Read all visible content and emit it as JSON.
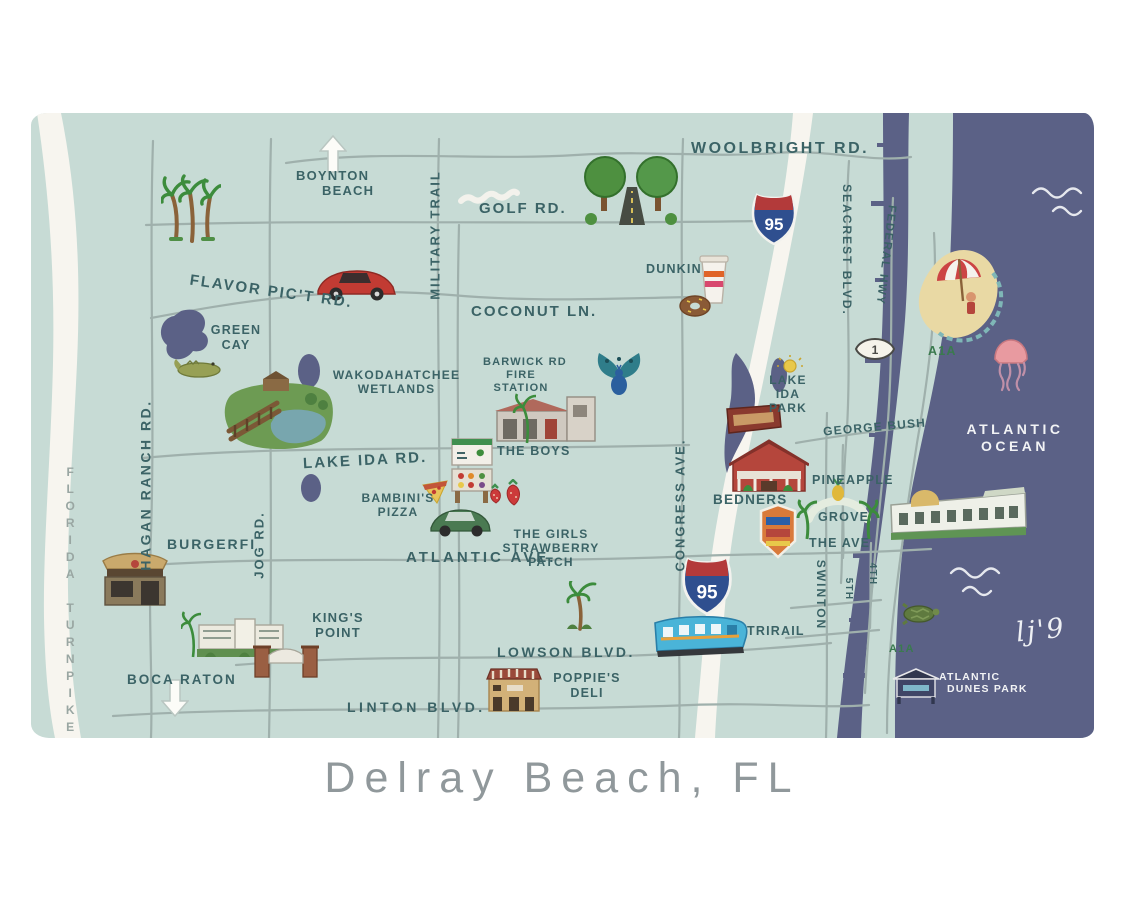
{
  "title": "Delray Beach, FL",
  "signature": "lj'9",
  "roads": {
    "woolbright": "WOOLBRIGHT RD.",
    "golf": "GOLF RD.",
    "flavor_pict": "FLAVOR PIC'T RD.",
    "coconut": "COCONUT LN.",
    "lake_ida": "LAKE IDA RD.",
    "atlantic": "ATLANTIC AVE.",
    "lowson": "LOWSON BLVD.",
    "linton": "LINTON BLVD.",
    "military": "MILITARY TRAIL",
    "hagan_ranch": "HAGAN RANCH RD.",
    "jog": "JOG RD.",
    "congress": "CONGRESS AVE.",
    "seacrest": "SEACREST BLVD.",
    "federal": "FEDERAL HWY",
    "swinton": "SWINTON",
    "fifth": "5TH",
    "fourth": "4TH",
    "george_bush": "GEORGE BUSH",
    "the_ave": "THE AVE",
    "a1a_north": "A1A",
    "a1a_south": "A1A",
    "turnpike": "FLORIDA TURNPIKE"
  },
  "places": {
    "boynton1": "BOYNTON",
    "boynton2": "BEACH",
    "boca": "BOCA RATON",
    "green1": "GREEN",
    "green2": "CAY",
    "wako1": "WAKODAHATCHEE",
    "wako2": "WETLANDS",
    "barwick1": "BARWICK RD",
    "barwick2": "FIRE",
    "barwick3": "STATION",
    "dunkin": "DUNKIN",
    "lip1": "LAKE",
    "lip2": "IDA",
    "lip3": "PARK",
    "bedners": "BEDNERS",
    "pineapple": "PINEAPPLE",
    "grove": "GROVE",
    "boys": "THE BOYS",
    "bambinis1": "BAMBINI'S",
    "bambinis2": "PIZZA",
    "girls1": "THE GIRLS",
    "girls2": "STRAWBERRY",
    "girls3": "PATCH",
    "burgerfi": "BURGERFI",
    "kings1": "KING'S",
    "kings2": "POINT",
    "trirail": "TRIRAIL",
    "poppies1": "POPPIE'S",
    "poppies2": "DELI",
    "dunes1": "ATLANTIC",
    "dunes2": "DUNES PARK",
    "ocean1": "ATLANTIC",
    "ocean2": "OCEAN"
  },
  "shields": {
    "i95": "95",
    "us1": "1"
  },
  "colors": {
    "land": "#c7dbd5",
    "water": "#5b6186",
    "white_road": "#f7f5ef",
    "gray_road": "#9fb0ac",
    "label": "#3b6366",
    "sand": "#e9d9a4"
  },
  "icons": [
    "palm-trees",
    "north-arrow",
    "golf-scribble",
    "tree-lined-road",
    "red-car",
    "alligator",
    "wetlands-boardwalk",
    "fire-station",
    "peacock",
    "coffee-cup",
    "donut",
    "sun",
    "bedners-sign",
    "barn-market",
    "market-stand",
    "pizza-slice",
    "strawberries",
    "green-car",
    "burger-restaurant",
    "condo-building",
    "entrance-gate",
    "south-arrow",
    "deli-building",
    "palm-tree",
    "i95-shield",
    "us1-marker",
    "commuter-train",
    "grove-arch",
    "street-sign",
    "beach-umbrella",
    "jellyfish",
    "beachfront-building",
    "sea-turtle",
    "park-pavilion",
    "ocean-waves"
  ]
}
